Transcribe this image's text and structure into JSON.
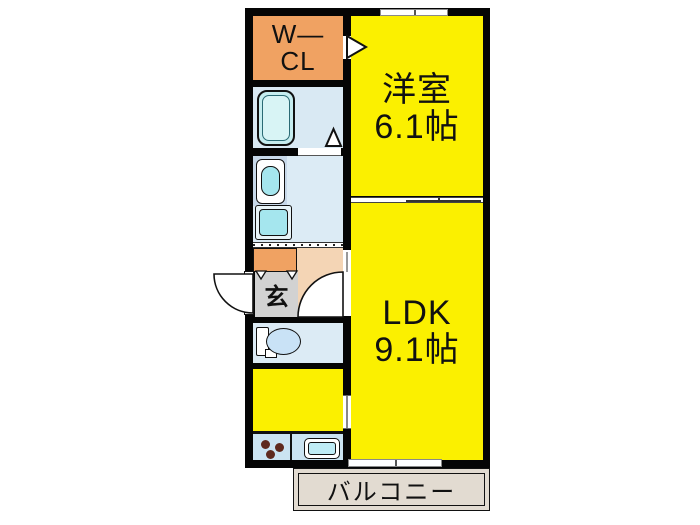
{
  "plan": {
    "rooms": {
      "wcl": {
        "line1": "W—",
        "line2": "CL"
      },
      "western_room": {
        "name": "洋室",
        "area": "6.1帖"
      },
      "ldk": {
        "name": "LDK",
        "area": "9.1帖"
      },
      "entrance": {
        "label": "玄"
      },
      "balcony": {
        "label": "バルコニー"
      }
    },
    "colors": {
      "room_yellow": "#FBF000",
      "closet_orange": "#F0A262",
      "wet_area_blue": "#DCEBF5",
      "fixture_cyan": "#A5E6EE",
      "entrance_gray": "#D2D2D2",
      "hallway_peach": "#F4D5B5",
      "balcony_beige": "#E2DBD1",
      "wall_black": "#050505"
    },
    "fixtures": [
      "bathtub",
      "vanity-sink",
      "washing-machine-pan",
      "toilet",
      "kitchen-counter",
      "gas-stove",
      "kitchen-sink",
      "entrance-door",
      "hallway-door",
      "sliding-doors",
      "windows"
    ]
  }
}
